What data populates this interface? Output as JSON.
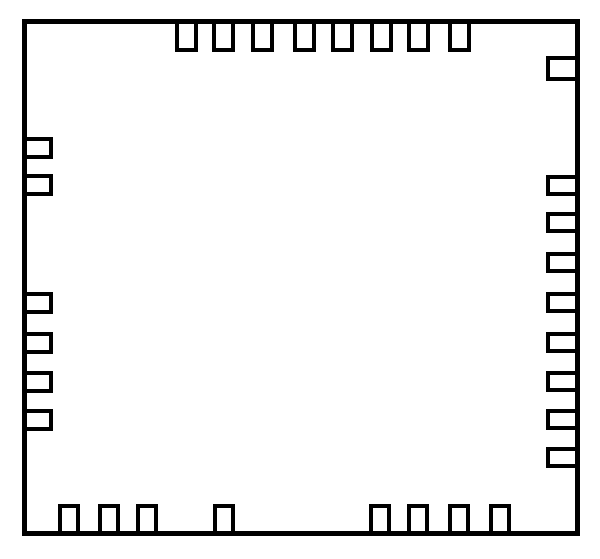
{
  "diagram": {
    "shape": "ic-package-outline-top-view",
    "canvas": {
      "width": 600,
      "height": 559
    },
    "colors": {
      "line": "#000000",
      "background": "#ffffff",
      "fill": "#ffffff"
    },
    "body": {
      "x": 22,
      "y": 19,
      "width": 558,
      "height": 517,
      "stroke": 5
    },
    "pin_stroke": 4,
    "pin_counts": {
      "top": 8,
      "right": 9,
      "bottom": 8,
      "left": 6,
      "total": 31
    },
    "pins": {
      "top": {
        "size": 23,
        "depth": 28,
        "positions": [
          175,
          212,
          251,
          293,
          331,
          370,
          407,
          448
        ]
      },
      "right": {
        "size": 21,
        "depth": 29,
        "positions": [
          56,
          175,
          212,
          252,
          292,
          332,
          371,
          409,
          447
        ],
        "size_overrides": {
          "0": 25
        }
      },
      "bottom": {
        "size": 22,
        "depth": 27,
        "positions": [
          58,
          98,
          136,
          213,
          369,
          407,
          448,
          489
        ]
      },
      "left": {
        "size": 22,
        "depth": 26,
        "positions": [
          137,
          174,
          292,
          332,
          371,
          409
        ]
      }
    }
  }
}
